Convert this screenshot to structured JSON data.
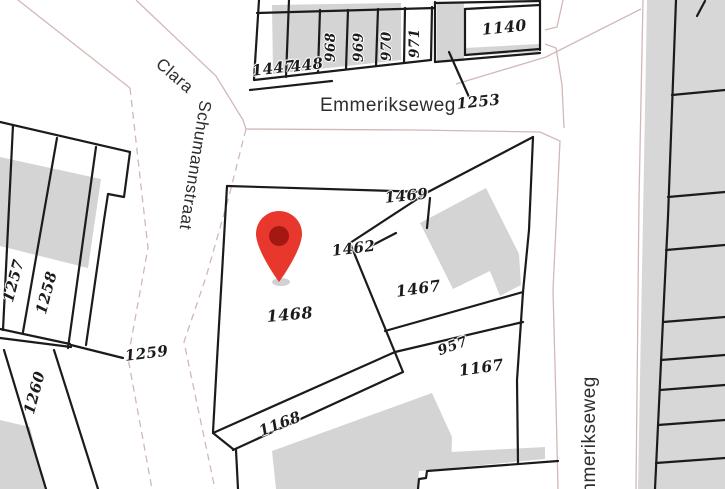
{
  "map": {
    "type": "cadastral-map",
    "streets": {
      "clara_part1": "Clara",
      "clara_part2": "Schumannstraat",
      "emmerikseweg_top": "Emmerikseweg",
      "emmerikseweg_right": "Emmerikseweg"
    },
    "parcel_labels": {
      "p1447": "1447",
      "p448": "448",
      "p968": "968",
      "p969": "969",
      "p970": "970",
      "p971": "971",
      "p1140": "1140",
      "p1253": "1253",
      "p1257": "1257",
      "p1258": "1258",
      "p1259": "1259",
      "p1260": "1260",
      "p1469": "1469",
      "p1462": "1462",
      "p1467": "1467",
      "p1468": "1468",
      "p957": "957",
      "p1167": "1167",
      "p1168": "1168"
    },
    "marker": {
      "kind": "location-pin",
      "color": "#e8382d",
      "inner_color": "#a51712"
    },
    "colors": {
      "background": "#ffffff",
      "parcel_line": "#1b1b1b",
      "building_fill": "#d4d4d4",
      "block_fill": "#d7d7d7",
      "street_edge": "#d2b8b6",
      "label_text": "#1b1b1b",
      "street_text": "#2e2e2e"
    }
  }
}
